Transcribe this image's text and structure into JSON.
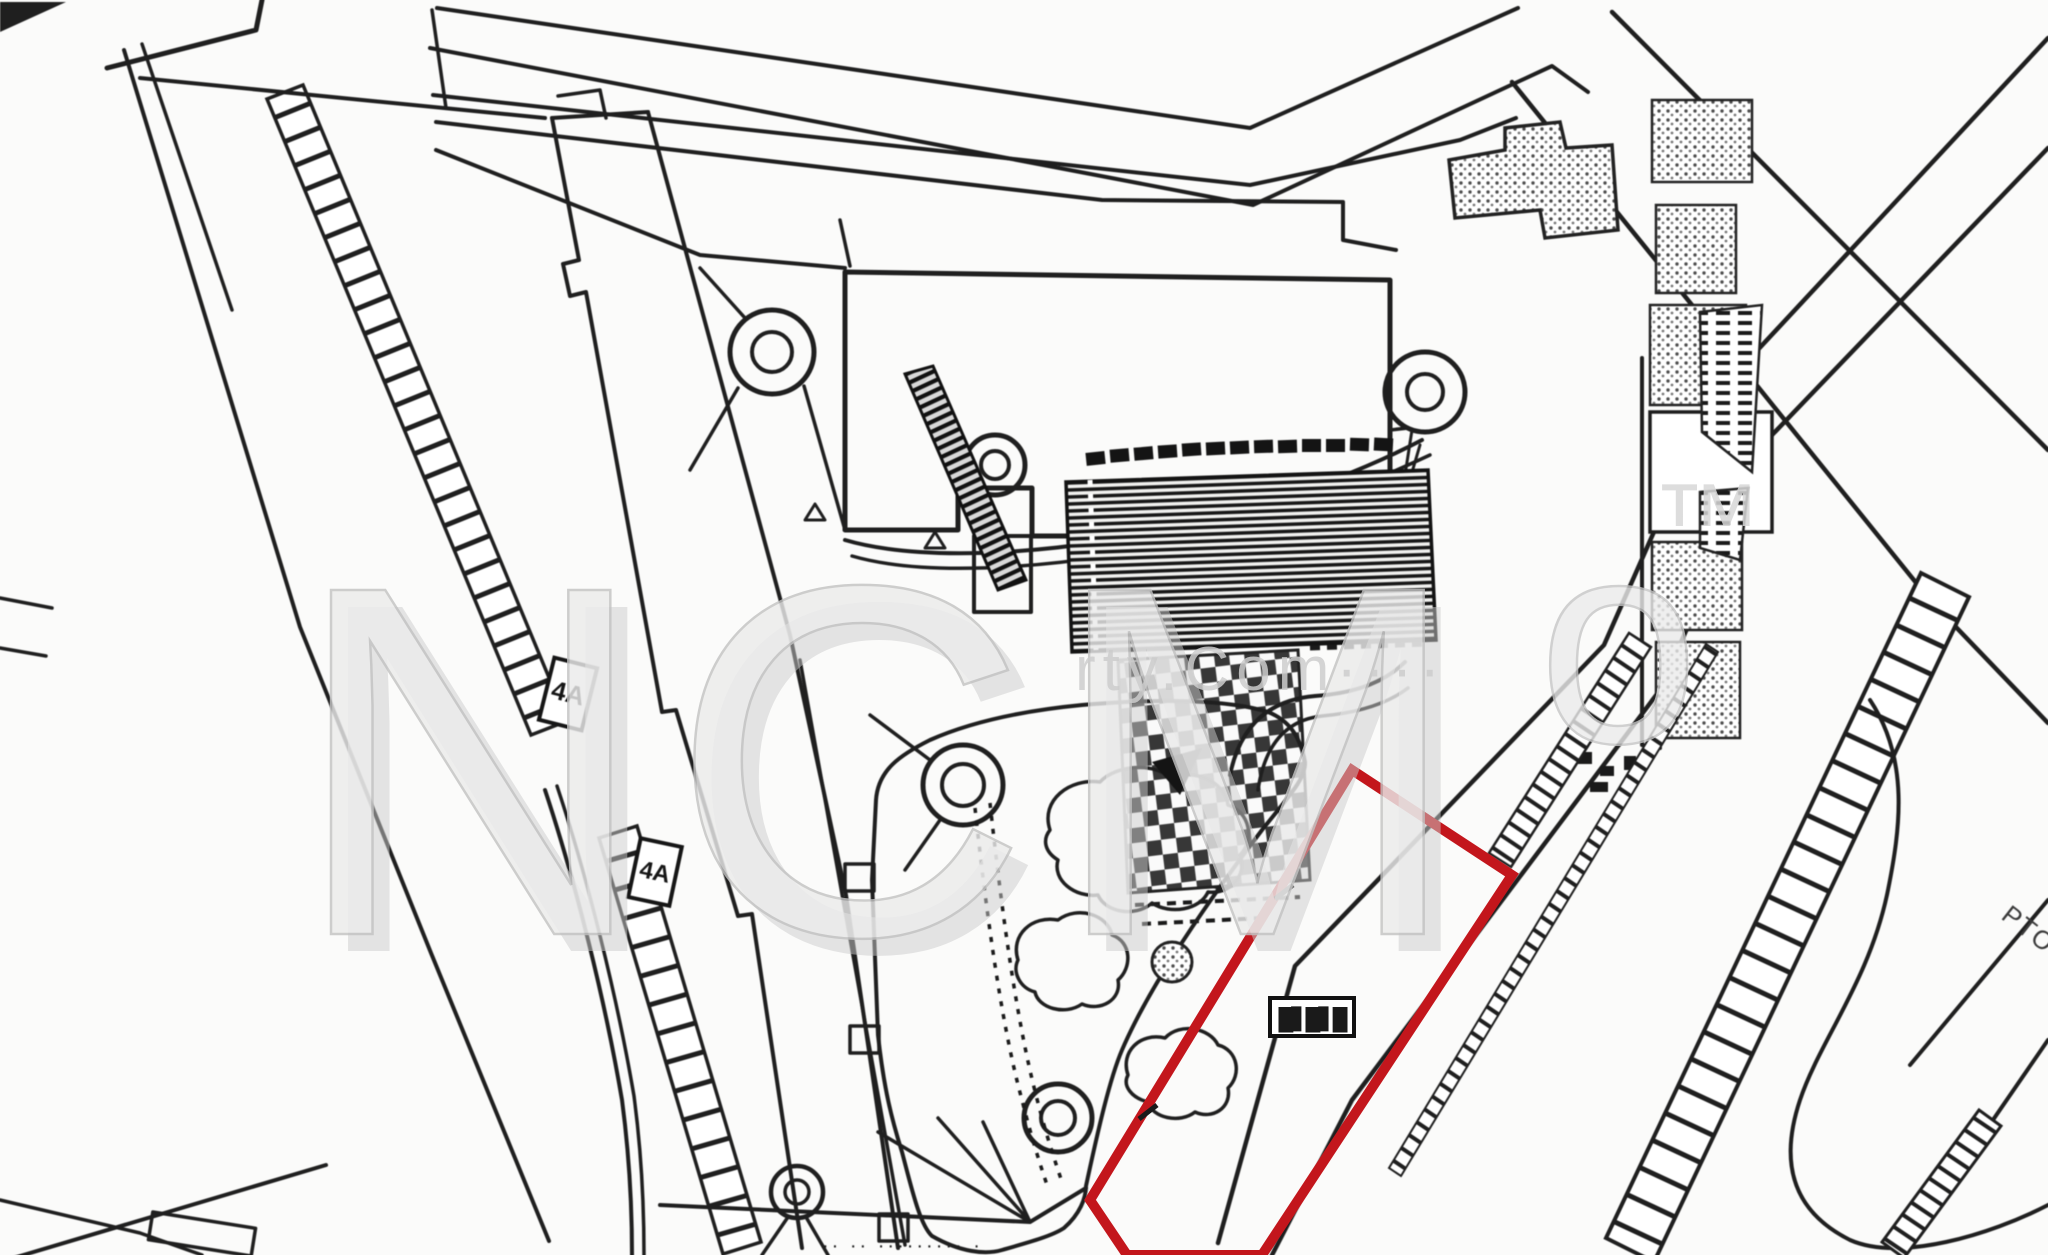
{
  "page": {
    "background": "#fbfbfa",
    "ink_color": "#1f1f1f",
    "plot_outline_color": "#c3161c",
    "watermark_color": "#e9e9e9",
    "watermark_shadow": "#c6c6c6"
  },
  "watermark": {
    "main_text": "NCM",
    "suffix_text": "o",
    "tm_text": "™",
    "small_text": "rty.Com····"
  },
  "plot": {
    "label": "█▋█▋█"
  },
  "labels": {
    "strip_label_1": "4A",
    "strip_label_2": "4A",
    "corner_note": "PTO",
    "bottom_note": "·· ·· ········· ·"
  }
}
